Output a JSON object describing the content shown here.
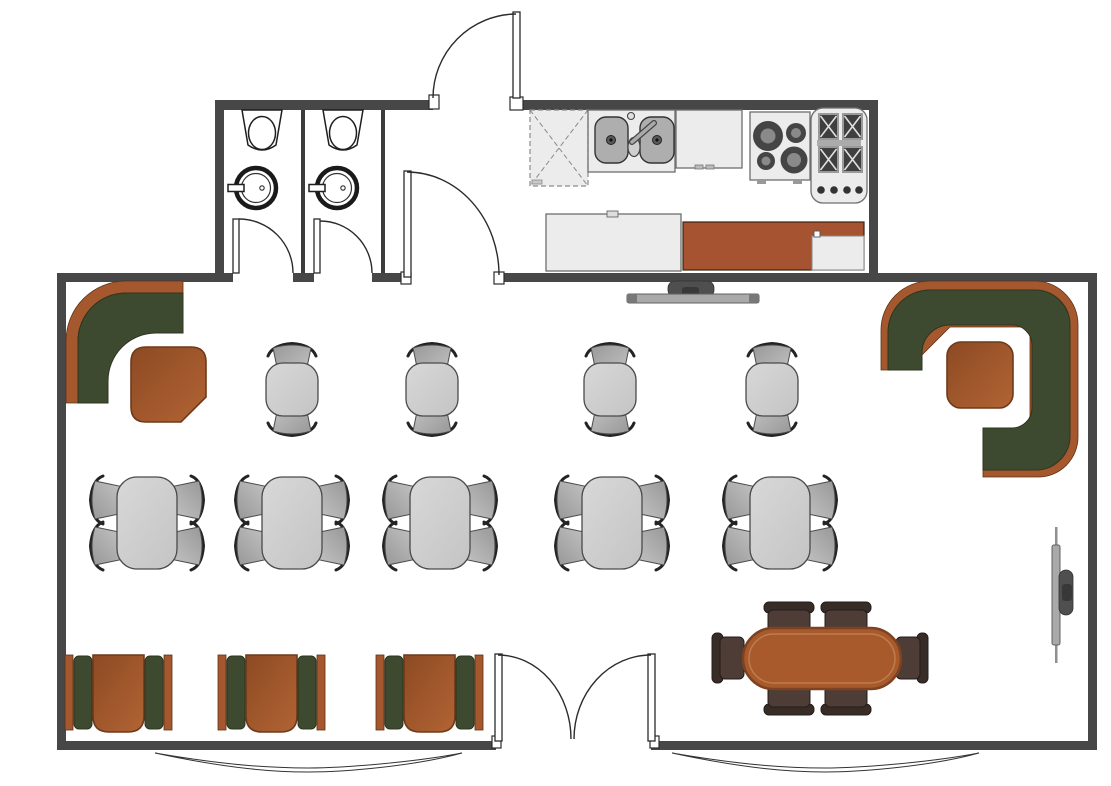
{
  "meta": {
    "title": "Cafe floor plan - top view",
    "canvas_width": 1111,
    "canvas_height": 786
  },
  "colors": {
    "wall": "#474747",
    "wall_thin": "#3c3c3c",
    "outline": "#1f1f1f",
    "door_stroke": "#2b2b2b",
    "window_stroke": "#333333",
    "appliance_light": "#ececec",
    "appliance_stroke": "#6e6e6e",
    "basin": "#aeaeae",
    "burner": "#454545",
    "burner_center": "#8a8a8a",
    "counter_rust": "#a65331",
    "bench_green": "#3e4a2f",
    "bench_green_dark": "#2c351f",
    "booth_rust": "#a5582e",
    "table_brown_deep": "#8d4a23",
    "table_brown_light": "#b26434",
    "table_brown_edge": "#6e3a1b",
    "table_gray_light": "#d8d8d8",
    "table_gray_dark": "#c4c4c4",
    "table_gray_stroke": "#4a4a4a",
    "chair_gray_light": "#c6c6c6",
    "chair_gray_dark": "#989898",
    "chair_arc": "#232323",
    "dark_chair": "#4e3c37",
    "dark_chair_bar": "#382c27",
    "dark_chair_stroke": "#241c19",
    "big_table": "#a85a2c",
    "big_table_edge": "#7d4220",
    "big_table_inner": "#bd7c4e",
    "tv_screen": "#a9a9a9",
    "tv_mount": "#4f4f4f"
  },
  "inventory": {
    "rooms": [
      {
        "name": "dining-area"
      },
      {
        "name": "kitchen"
      },
      {
        "name": "restroom-stall",
        "count": 2
      },
      {
        "name": "entry-vestibule"
      }
    ],
    "furniture": [
      {
        "item": "corner-booth-with-table",
        "count": 2
      },
      {
        "item": "table-for-two-with-chairs",
        "count": 4
      },
      {
        "item": "table-for-four-with-chairs",
        "count": 5
      },
      {
        "item": "window-booth-with-table",
        "count": 3
      },
      {
        "item": "oval-table-with-six-chairs",
        "count": 1
      }
    ],
    "fixtures": [
      {
        "item": "toilet",
        "count": 2
      },
      {
        "item": "round-washbasin",
        "count": 2
      },
      {
        "item": "dishwasher",
        "count": 1
      },
      {
        "item": "double-sink",
        "count": 1
      },
      {
        "item": "base-cabinet",
        "count": 1
      },
      {
        "item": "electric-cooktop",
        "count": 1
      },
      {
        "item": "gas-range",
        "count": 1
      },
      {
        "item": "kitchen-counter",
        "count": 2
      },
      {
        "item": "wall-mounted-tv",
        "count": 2
      },
      {
        "item": "double-entry-door",
        "count": 1
      },
      {
        "item": "single-door",
        "count": 4
      },
      {
        "item": "bay-window",
        "count": 2
      }
    ]
  }
}
